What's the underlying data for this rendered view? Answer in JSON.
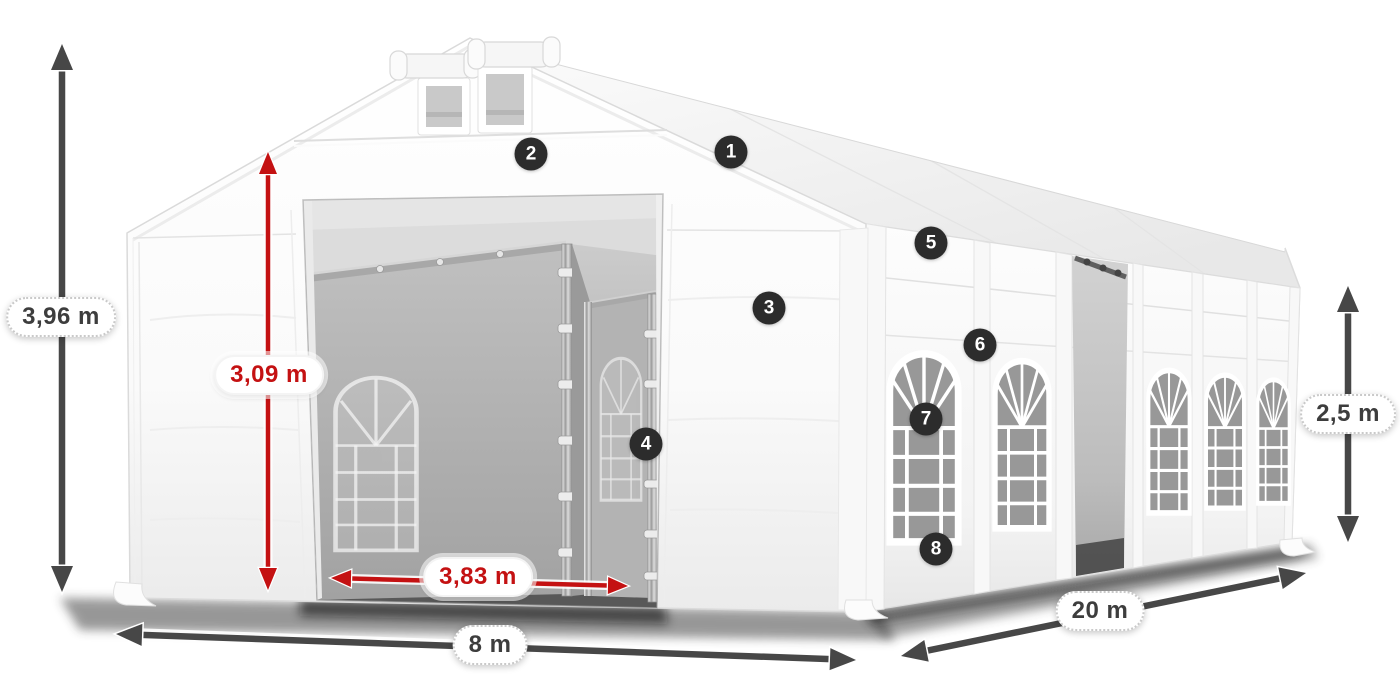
{
  "dimensions": {
    "total_height": {
      "label": "3,96 m"
    },
    "entrance_height": {
      "label": "3,09 m"
    },
    "entrance_width": {
      "label": "3,83 m"
    },
    "width": {
      "label": "8 m"
    },
    "length": {
      "label": "20 m"
    },
    "side_height": {
      "label": "2,5 m"
    }
  },
  "badges": [
    {
      "number": "1"
    },
    {
      "number": "2"
    },
    {
      "number": "3"
    },
    {
      "number": "4"
    },
    {
      "number": "5"
    },
    {
      "number": "6"
    },
    {
      "number": "7"
    },
    {
      "number": "8"
    }
  ],
  "colors": {
    "dimension_red": "#c41112",
    "dimension_dark": "#474747",
    "badge_background": "#2c2c2c",
    "tent_white": "#ffffff"
  }
}
